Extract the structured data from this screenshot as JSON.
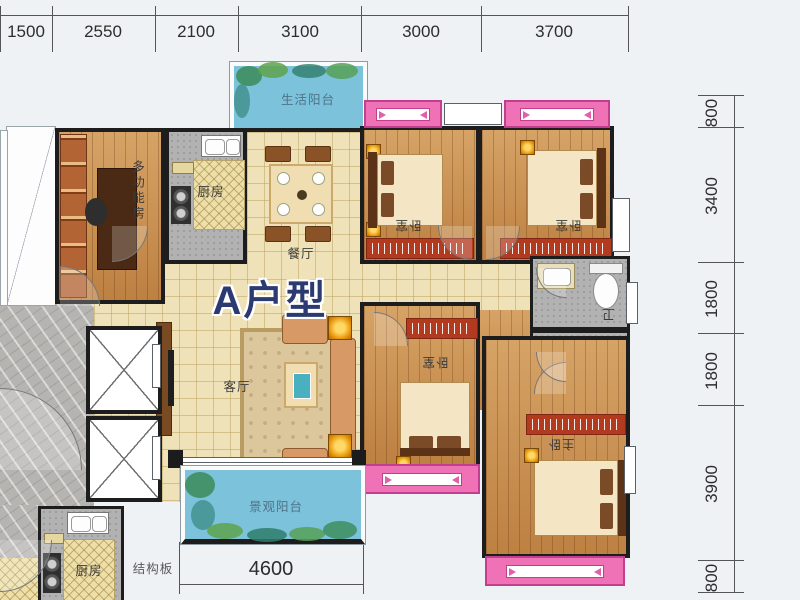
{
  "title": "A户型",
  "dimensions": {
    "top": [
      "1500",
      "2550",
      "2100",
      "3100",
      "3000",
      "3700"
    ],
    "right": [
      "800",
      "3400",
      "1800",
      "1800",
      "3900",
      "800"
    ],
    "bottom": "4600"
  },
  "rooms": {
    "life_balcony": "生活阳台",
    "multi_function": "多功能房",
    "kitchen": "厨房",
    "dining": "餐厅",
    "bedroom_top_left": "卧室",
    "bedroom_top_right": "卧室",
    "bedroom_middle": "卧室",
    "master_bedroom": "主卧",
    "bath_upper": "卫",
    "bath_lower": "卫",
    "living": "客厅",
    "view_balcony": "景观阳台",
    "neighbor_kitchen": "厨房",
    "structure_board": "结构板"
  },
  "colors": {
    "accent_pink": "#ee72b5",
    "balcony_blue": "#7cc2da",
    "title_navy": "#2c3a72",
    "wood": "#c9924f",
    "tile": "#efe2b8"
  }
}
